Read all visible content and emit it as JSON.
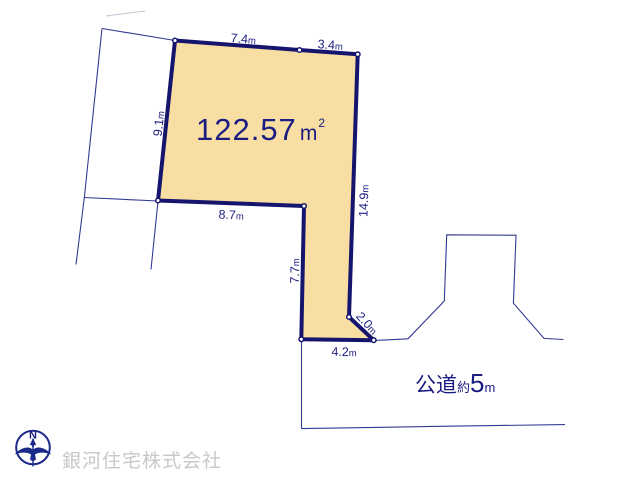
{
  "plan": {
    "area_label": {
      "value": "122.57",
      "unit_base": "m",
      "unit_sup": "2"
    },
    "dimensions": {
      "top_left": {
        "value": "7.4",
        "unit": "m"
      },
      "top_right": {
        "value": "3.4",
        "unit": "m"
      },
      "left": {
        "value": "9.1",
        "unit": "m"
      },
      "right": {
        "value": "14.9",
        "unit": "m"
      },
      "inner_step": {
        "value": "8.7",
        "unit": "m"
      },
      "inner_left": {
        "value": "7.7",
        "unit": "m"
      },
      "corner_cut": {
        "value": "2.0",
        "unit": "m"
      },
      "bottom": {
        "value": "4.2",
        "unit": "m"
      }
    },
    "road_label": {
      "type": "公道",
      "approx": "約",
      "width": "5",
      "unit": "m"
    },
    "compass": {
      "north": "N"
    },
    "watermark": {
      "company": "銀河住宅株式会社"
    },
    "colors": {
      "parcel_fill": "#F8DEA2",
      "parcel_border": "#15156E",
      "thin_line": "#333A94",
      "label_text": "#1B1C82",
      "watermark_gray": "#C8C8C8"
    }
  }
}
